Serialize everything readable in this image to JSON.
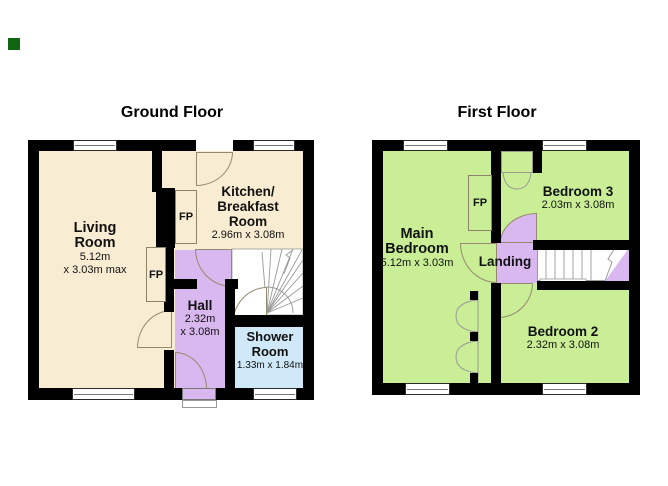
{
  "palette": {
    "room_cream": "#f8ecd2",
    "room_green": "#c9ee96",
    "hall_purple": "#d9b8f0",
    "shower_blue": "#cfe9f8",
    "wall_black": "#000000",
    "marker_green": "#116611"
  },
  "ground_floor": {
    "title": "Ground Floor",
    "living_room": {
      "line1": "Living",
      "line2": "Room",
      "dim1": "5.12m",
      "dim2": "x 3.03m max"
    },
    "kitchen": {
      "line1": "Kitchen/",
      "line2": "Breakfast",
      "line3": "Room",
      "dims": "2.96m x 3.08m"
    },
    "hall": {
      "name": "Hall",
      "dim1": "2.32m",
      "dim2": "x 3.08m"
    },
    "shower_room": {
      "line1": "Shower",
      "line2": "Room",
      "dims": "1.33m x 1.84m"
    },
    "fireplace_kitchen": "FP",
    "fireplace_living": "FP"
  },
  "first_floor": {
    "title": "First Floor",
    "main_bedroom": {
      "line1": "Main",
      "line2": "Bedroom",
      "dims": "5.12m x 3.03m"
    },
    "bedroom_3": {
      "name": "Bedroom 3",
      "dims": "2.03m x 3.08m"
    },
    "landing": {
      "name": "Landing"
    },
    "bedroom_2": {
      "name": "Bedroom 2",
      "dims": "2.32m x 3.08m"
    },
    "fireplace": "FP"
  }
}
